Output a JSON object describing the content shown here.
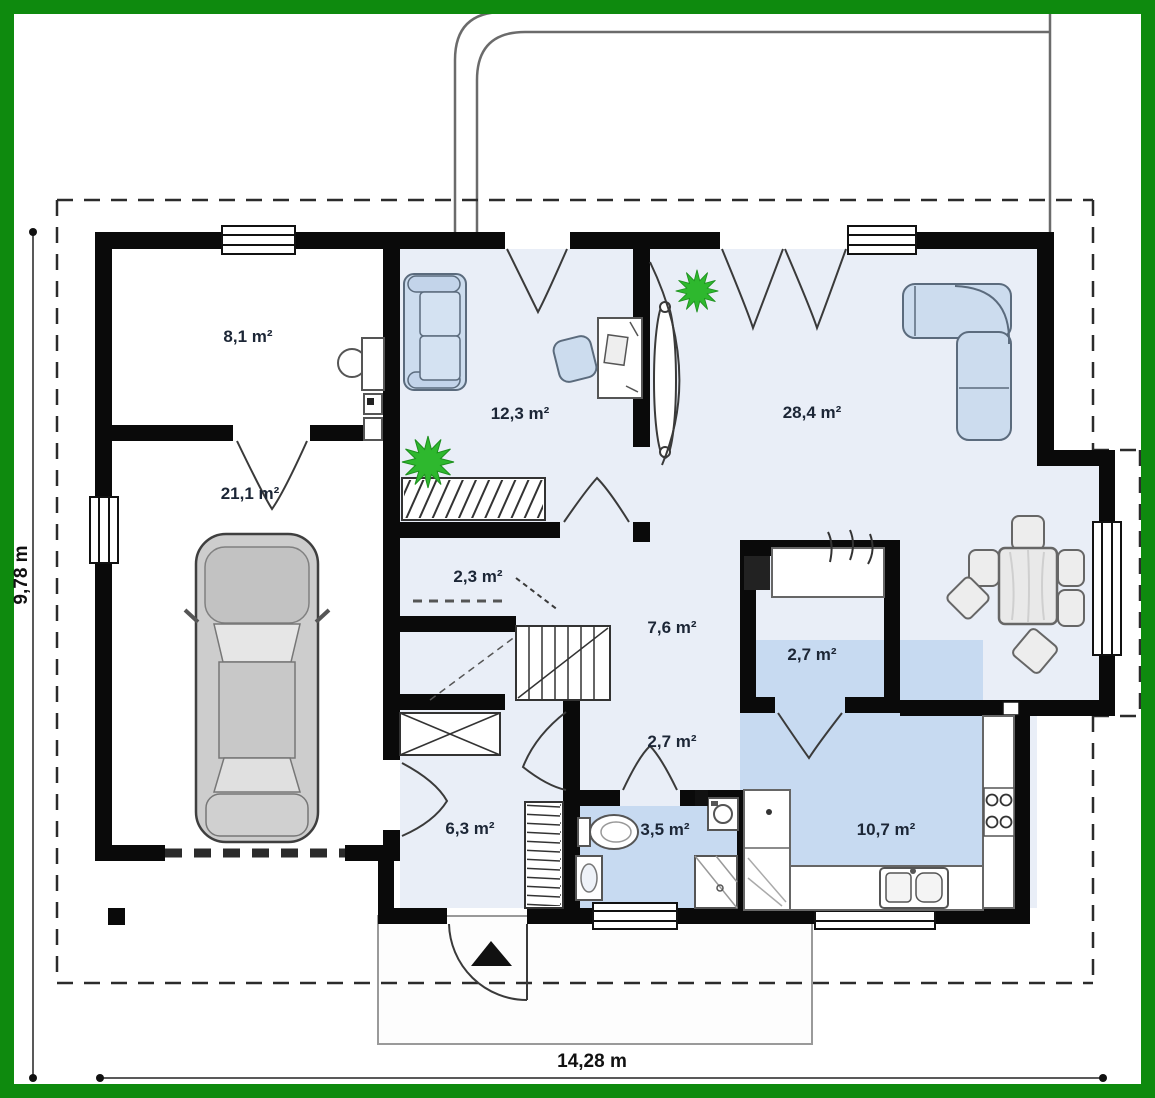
{
  "plan": {
    "type": "house-floor-plan",
    "rooms": [
      {
        "key": "utility-room",
        "area_label": "8,1 m²"
      },
      {
        "key": "garage",
        "area_label": "21,1 m²"
      },
      {
        "key": "office",
        "area_label": "12,3 m²"
      },
      {
        "key": "living-room",
        "area_label": "28,4 m²"
      },
      {
        "key": "closet",
        "area_label": "2,3 m²"
      },
      {
        "key": "hall",
        "area_label": "7,6 m²"
      },
      {
        "key": "corridor",
        "area_label": "2,7 m²"
      },
      {
        "key": "pantry",
        "area_label": "2,7 m²"
      },
      {
        "key": "entry",
        "area_label": "6,3 m²"
      },
      {
        "key": "bathroom",
        "area_label": "3,5 m²"
      },
      {
        "key": "kitchen",
        "area_label": "10,7 m²"
      }
    ],
    "dimensions": {
      "overall_width": "14,28 m",
      "overall_height": "9,78 m"
    },
    "icons": {
      "plant": "plant-icon",
      "car": "car-icon",
      "entrance_arrow": "entrance-arrow-icon"
    },
    "colors": {
      "frame_green": "#0e8a0e",
      "wall_black": "#0a0a0a",
      "floor_tint": "#e9eef7",
      "wet_room_floor": "#c7daf1",
      "furniture_blue": "#ccdcee",
      "plant_green": "#2eb82e"
    }
  }
}
